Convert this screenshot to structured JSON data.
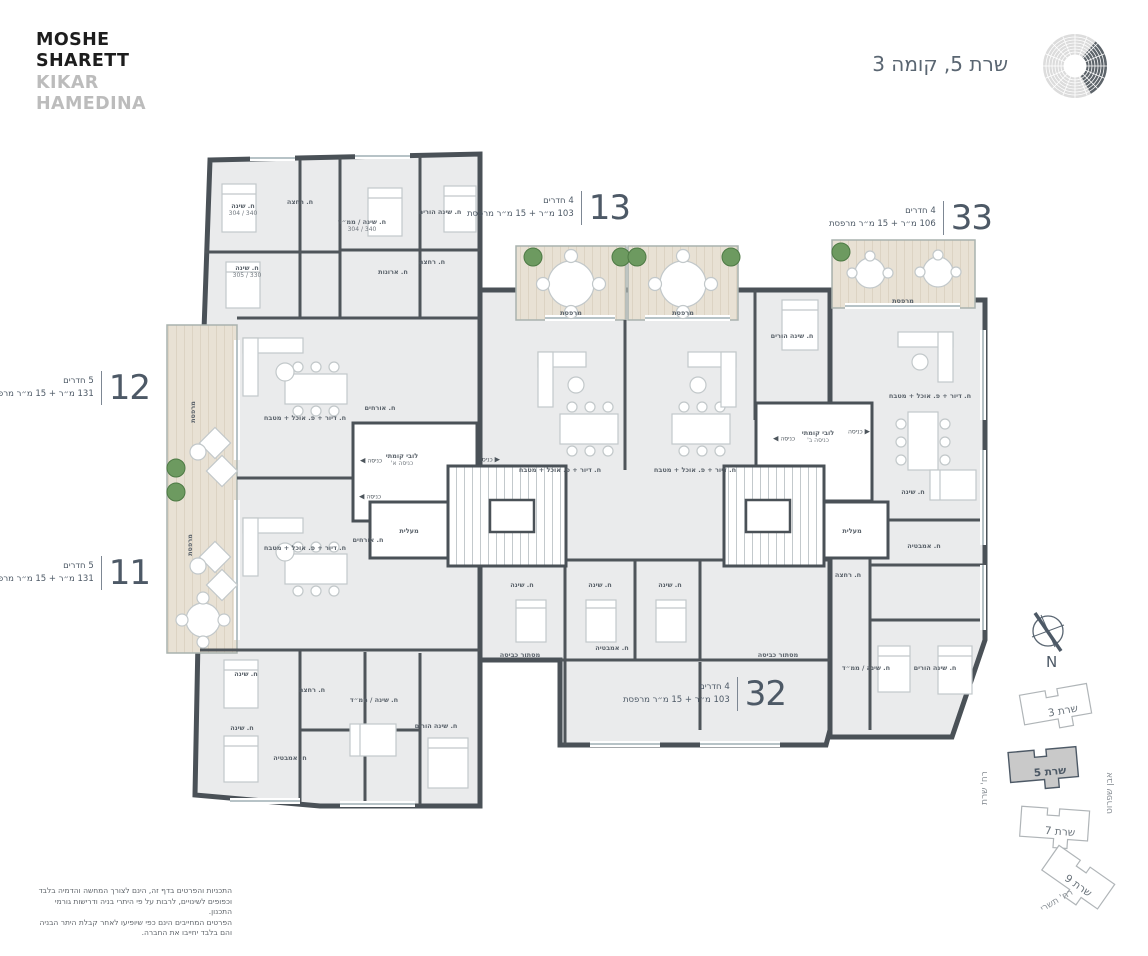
{
  "header": {
    "logo_line1": "MOSHE",
    "logo_line2": "SHARETT",
    "logo_line3": "KIKAR",
    "logo_line4": "HAMEDINA",
    "title": "שרת 5, קומה 3"
  },
  "colors": {
    "wall": "#4a5157",
    "floor": "#eaebec",
    "wood_balcony": "#e8e1d4",
    "accent_slate": "#4d5966",
    "plant_green": "#6d9a60",
    "current_building_fill": "#c9c9c9"
  },
  "units": [
    {
      "number": "13",
      "rooms": "4 חדרים",
      "area": "103 מ״ר + 15 מ״ר מרפסת"
    },
    {
      "number": "33",
      "rooms": "4 חדרים",
      "area": "106 מ״ר + 15 מ״ר מרפסת"
    },
    {
      "number": "12",
      "rooms": "5 חדרים",
      "area": "131 מ״ר + 15 מ״ר מרפסת"
    },
    {
      "number": "11",
      "rooms": "5 חדרים",
      "area": "131 מ״ר + 15 מ״ר מרפסת"
    },
    {
      "number": "32",
      "rooms": "4 חדרים",
      "area": "103 מ״ר + 15 מ״ר מרפסת"
    }
  ],
  "floor_plan": {
    "entrance_label": "כניסה",
    "entrances": [
      {
        "x": 371,
        "y": 461,
        "dir": "w"
      },
      {
        "x": 489,
        "y": 460,
        "dir": "e"
      },
      {
        "x": 370,
        "y": 497,
        "dir": "w"
      },
      {
        "x": 784,
        "y": 439,
        "dir": "w"
      },
      {
        "x": 859,
        "y": 432,
        "dir": "e"
      }
    ],
    "rooms": [
      {
        "t": "ח. שינה",
        "d": "340 / 304",
        "x": 243,
        "y": 210
      },
      {
        "t": "ח. רחצה",
        "x": 300,
        "y": 202
      },
      {
        "t": "ח. שינה / ממ״ד",
        "d": "340 / 304",
        "x": 362,
        "y": 226
      },
      {
        "t": "ח. שינה הורים",
        "x": 440,
        "y": 212
      },
      {
        "t": "ח. שינה",
        "d": "330 / 305",
        "x": 247,
        "y": 272
      },
      {
        "t": "ח. ארונות",
        "x": 393,
        "y": 272
      },
      {
        "t": "ח. רחצה",
        "x": 432,
        "y": 262
      },
      {
        "t": "מרפסת",
        "x": 193,
        "y": 412,
        "r": -90
      },
      {
        "t": "מרפסת",
        "x": 190,
        "y": 545,
        "r": -90
      },
      {
        "t": "ח. דיור + פ. אוכל + מטבח",
        "x": 305,
        "y": 418
      },
      {
        "t": "ח. אורחים",
        "x": 380,
        "y": 408
      },
      {
        "t": "ח. דיור + פ. אוכל + מטבח",
        "x": 305,
        "y": 548
      },
      {
        "t": "ח. אורחים",
        "x": 368,
        "y": 540
      },
      {
        "t": "לובי קומתי",
        "s": "כניסה א'",
        "x": 402,
        "y": 460
      },
      {
        "t": "מעלית",
        "x": 409,
        "y": 531
      },
      {
        "t": "לובי קומתי",
        "s": "כניסה ב'",
        "x": 818,
        "y": 437
      },
      {
        "t": "מעלית",
        "x": 852,
        "y": 531
      },
      {
        "t": "מרפסת",
        "x": 571,
        "y": 313
      },
      {
        "t": "מרפסת",
        "x": 683,
        "y": 313
      },
      {
        "t": "מרפסת",
        "x": 903,
        "y": 301
      },
      {
        "t": "ח. דיור + פ. אוכל + מטבח",
        "x": 560,
        "y": 470
      },
      {
        "t": "ח. דיור + פ. אוכל + מטבח",
        "x": 695,
        "y": 470
      },
      {
        "t": "ח. שינה הורים",
        "x": 792,
        "y": 336
      },
      {
        "t": "ח. דיור + פ. אוכל + מטבח",
        "x": 930,
        "y": 396
      },
      {
        "t": "ח. שינה",
        "x": 522,
        "y": 585
      },
      {
        "t": "ח. שינה",
        "x": 600,
        "y": 585
      },
      {
        "t": "ח. שינה",
        "x": 670,
        "y": 585
      },
      {
        "t": "ח. אמבטיה",
        "x": 612,
        "y": 648
      },
      {
        "t": "מסתור כביסה",
        "x": 520,
        "y": 655
      },
      {
        "t": "מסתור כביסה",
        "x": 778,
        "y": 655
      },
      {
        "t": "ח. שינה",
        "x": 246,
        "y": 674
      },
      {
        "t": "ח. שינה",
        "x": 242,
        "y": 728
      },
      {
        "t": "ח. רחצה",
        "x": 312,
        "y": 690
      },
      {
        "t": "ח. שינה / ממ״ד",
        "x": 374,
        "y": 700
      },
      {
        "t": "ח. שינה הורים",
        "x": 436,
        "y": 726
      },
      {
        "t": "ח. אמבטיה",
        "x": 290,
        "y": 758
      },
      {
        "t": "ח. שינה",
        "x": 913,
        "y": 492
      },
      {
        "t": "ח. אמבטיה",
        "x": 924,
        "y": 546
      },
      {
        "t": "ח. רחצה",
        "x": 848,
        "y": 575
      },
      {
        "t": "ח. שינה / ממ״ד",
        "x": 866,
        "y": 668
      },
      {
        "t": "ח. שינה הורים",
        "x": 935,
        "y": 668
      }
    ]
  },
  "site_map": {
    "north_label": "N",
    "buildings": [
      {
        "name": "שרת 3",
        "current": false
      },
      {
        "name": "שרת 5",
        "current": true
      },
      {
        "name": "שרת 7",
        "current": false
      },
      {
        "name": "שרת 9",
        "current": false
      }
    ],
    "streets": [
      {
        "name": "רח' שרת"
      },
      {
        "name": "אבן שפרוט"
      },
      {
        "name": "רח' תשרי"
      }
    ]
  },
  "disclaimer": {
    "line1": "התכניות והפרטים בדף זה, הינם לצורך המחשה והדמיה בלבד",
    "line2": "וכפופים לשינויים, לרבות על פי היתרי בניה ודרישות גורמי התכנון.",
    "line3": "הפרטים המחייבים הינם כפי שיופיעו לאחר קבלת היתר הבניה",
    "line4": "והם בלבד יחייבו את החברה."
  }
}
